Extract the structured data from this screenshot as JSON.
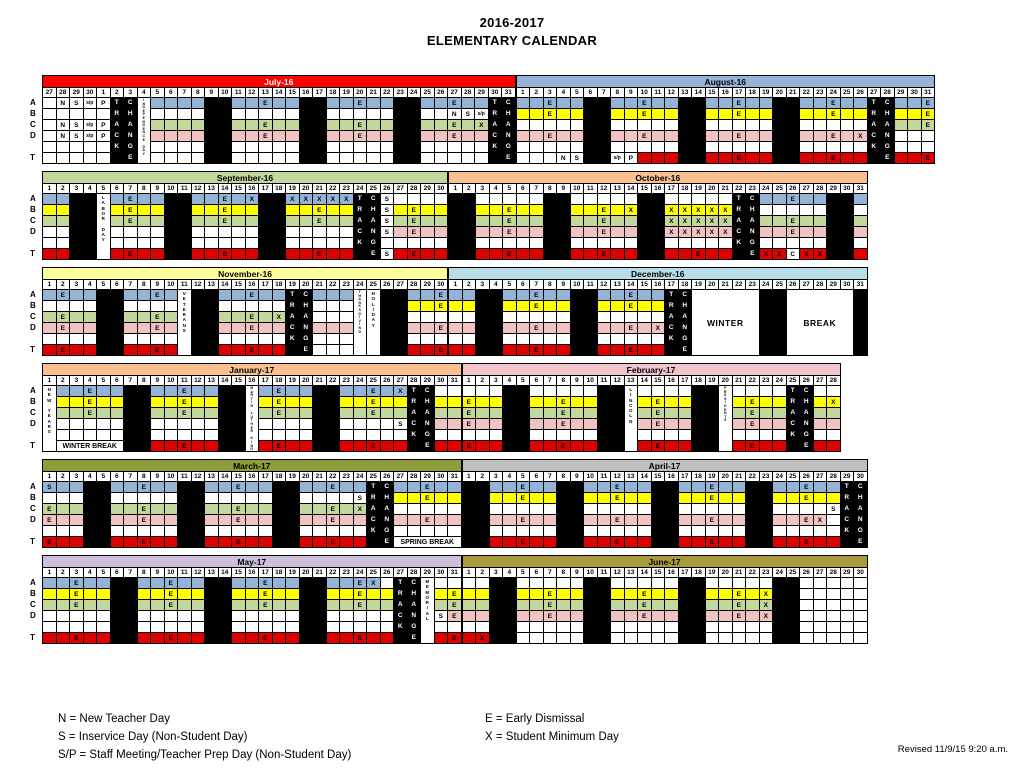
{
  "title": {
    "line1": "2016-2017",
    "line2": "ELEMENTARY CALENDAR"
  },
  "legend": {
    "n": "N = New Teacher Day",
    "s": "S = Inservice Day (Non-Student Day)",
    "sp": "S/P = Staff Meeting/Teacher Prep Day (Non-Student Day)",
    "e": "E = Early Dismissal",
    "x": "X = Student Minimum Day",
    "revised": "Revised 11/9/15 9:20 a.m."
  },
  "row_labels": [
    "A",
    "B",
    "C",
    "D",
    "",
    "T"
  ],
  "colors": {
    "a": "#95B3D7",
    "y": "#FFFF00",
    "g": "#C3D69B",
    "p": "#F0C2C4",
    "r": "#E00000",
    "k": "#000000",
    "w": "#FFFFFF"
  },
  "bands": [
    [
      0,
      1
    ],
    [
      2,
      3
    ],
    [
      4,
      5
    ],
    [
      6,
      7
    ],
    [
      8,
      9
    ],
    [
      10,
      11
    ]
  ],
  "months": [
    {
      "name": "July-16",
      "hbg": "#FF0000",
      "hfg": "#FFFFFF",
      "days": "27 28 29 30 1 2 3 4 5 6 7 8 9 10 11 12 13 14 15 16 17 18 19 20 21 22 23 24 25 26 27 28 29 30 31",
      "track_cols": {
        "5": "TRACK",
        "6": "CHANGE",
        "33": "TRACK",
        "34": "CHANGE"
      },
      "vcols": [
        {
          "col": 7,
          "text": "INDEPENDENCE DAY",
          "tiny": true
        }
      ],
      "merges": [],
      "rows": [
        "w w:N w:S w:s/p w:P k k w a a a a k k a a a:E a a k k a a a:E a a k k a a a:E a a k k",
        "w w w w w k k w w w w w k k w w w w w k k w w w w w k k w w w:N w:S w:s/p k k",
        "w w:N w:S w:s/p w:P k k w g g g g k k g g g:E g g k k g g g:E g g k k g g g:E g g:X k k",
        "w w:N w:S w:s/p w:P k k w p p p p k k p p p:E p p k k p p p:E p p k k p p p:E p p k k",
        "w w w w w k k w w w w w k k w w w w w k k w w w w w k k w w w w w k k",
        "w w w w w k k w w w w w k k w w w w w k k w w w w w k k w w w w w k k"
      ]
    },
    {
      "name": "August-16",
      "hbg": "#95B3D7",
      "hfg": "#000000",
      "days": "1 2 3 4 5 6 7 8 9 10 11 12 13 14 15 16 17 18 19 20 21 22 23 24 25 26 27 28 29 30 31",
      "track_cols": {
        "26": "TRACK",
        "27": "CHANGE"
      },
      "vcols": [],
      "merges": [],
      "rows": [
        "a a a:E a a k k a a a:E a a k k a a a:E a a k k a a a:E a a k k a a a:E",
        "y y y:E y y k k y y y:E y y k k y y y:E y y k k y y y:E y y k k y y y:E",
        "w w w w w k k w w w w w k k w w w w w k k w w w w w k k g g g:E",
        "p p p:E p p k k p p p:E p p k k p p p:E p p k k p p p:E p p:X k k w w w",
        "w w w w w k k w w w w w k k w w w w w k k w w w w w k k w w w",
        "w w w w:N w:S k k w:s/p w:P r r r k k r r r:E r r k k r r r:E r r k k r r r:E"
      ]
    },
    {
      "name": "September-16",
      "hbg": "#C3D69B",
      "hfg": "#000000",
      "days": "1 2 3 4 5 6 7 8 9 10 11 12 13 14 15 16 17 18 19 20 21 22 23 24 25 26 27 28 29 30",
      "track_cols": {
        "23": "TRACK",
        "24": "CHANGE"
      },
      "vcols": [
        {
          "col": 4,
          "text": "LABOR DAY",
          "tiny": false
        }
      ],
      "merges": [],
      "rows": [
        "a a k k w a a:E a a k k a a a:E a a:X k k a:X a:X a:X a:X a:X k k w:S w w w w",
        "y y k k w y y:E y y k k y y y:E y y k k y y y:E y y k k w:S y y:E y y",
        "g g k k w g g:E g g k k g g g:E g g k k g g g:E g g k k w:S g g:E g g",
        "w w k k w w w w w k k w w w w w k k w w w w w k k w:S p p:E p p",
        "w w k k w w w w w k k w w w w w k k w w w w w k k w w w w w",
        "r r k k w r r:E r r k k r r r:E r r k k r r r:E r r k k w:S r r:E r r"
      ]
    },
    {
      "name": "October-16",
      "hbg": "#FAC090",
      "hfg": "#000000",
      "days": "1 2 3 4 5 6 7 8 9 10 11 12 13 14 15 16 17 18 19 20 21 22 23 24 25 26 27 28 29 30 31",
      "track_cols": {
        "21": "TRACK",
        "22": "CHANGE"
      },
      "vcols": [],
      "merges": [],
      "rows": [
        "k k w w w w w k k w w w w w k k w w w w w k k a a a:E a a k k a",
        "k k y y y:E y y k k y y y:E y y:X k k y:X y:X y:X y:X y:X k k w w w w w k k w",
        "k k g g g:E g g k k g g g:E g g k k g:X g:X g:X g:X g:X k k g g g:E g g k k g",
        "k k p p p:E p p k k p p p:E p p k k p:X p:X p:X p:X p:X k k p p p:E p p k k p",
        "k k w w w w w k k w w w w w k k w w w w w k k w w w w w k k w",
        "k k r r r:E r r k k r r r:E r r k k r r r:E r r k k r:X r:X w:C r:X r:X k k r"
      ]
    },
    {
      "name": "November-16",
      "hbg": "#FFFF99",
      "hfg": "#000000",
      "days": "1 2 3 4 5 6 7 8 9 10 11 12 13 14 15 16 17 18 19 20 21 22 23 24 25 26 27 28 29 30",
      "track_cols": {
        "18": "TRACK",
        "19": "CHANGE"
      },
      "vcols": [
        {
          "col": 10,
          "text": "VETERANS",
          "tiny": false
        },
        {
          "col": 23,
          "text": "THANKSGIVING",
          "tiny": true
        },
        {
          "col": 24,
          "text": "HOLIDAY",
          "tiny": false
        }
      ],
      "merges": [],
      "rows": [
        "a a:E a a k k a a a:E a w k k a a a:E a a k k a a a w w k k a a a:E",
        "w w w w k k w w w w w k k w w w w w k k w w w w w k k y y y:E",
        "g g:E g g k k g g g:E g w k k g g g:E g g:X k k w w w w w k k w w w",
        "p p:E p p k k p p p:E p w k k p p p:E p p k k p p p w w k k p p p:E",
        "w w w w k k w w w w w k k w w w w w k k w w w w w k k w w w",
        "r r:E r r k k r r r:E r w k k r r r:E r r k k w w w w w k k r r r:E"
      ]
    },
    {
      "name": "December-16",
      "hbg": "#B7DEE8",
      "hfg": "#000000",
      "days": "1 2 3 4 5 6 7 8 9 10 11 12 13 14 15 16 17 18 19 20 21 22 23 24 25 26 27 28 29 30 31",
      "track_cols": {
        "16": "TRACK",
        "17": "CHANGE"
      },
      "vcols": [],
      "merges": [
        {
          "r0": 0,
          "r1": 5,
          "c0": 18,
          "c1": 22,
          "text": "WINTER",
          "big": true
        },
        {
          "r0": 0,
          "r1": 5,
          "c0": 25,
          "c1": 29,
          "text": "BREAK",
          "big": true
        }
      ],
      "rows": [
        "a a k k a a a:E a a k k a a a:E a a k k w w w w w k k w w w w w k",
        "y y k k y y y:E y y k k y y y:E y y k k w w w w w k k w w w w w k",
        "w w k k w w w w w k k w w w w w k k w w w w w k k w w w w w k",
        "p p k k p p p:E p p k k p p p:E p p:X k k w w w w w k k w w w w w k",
        "w w k k w w w w w k k w w w w w k k w w w w w k k w w w w w k",
        "r r k k r r r:E r r k k r r r:E r r k k w w w w w k k w w w w w k"
      ]
    },
    {
      "name": "January-17",
      "hbg": "#FAC090",
      "hfg": "#000000",
      "days": "1 2 3 4 5 6 7 8 9 10 11 12 13 14 15 16 17 18 19 20 21 22 23 24 25 26 27 28 29 30 31",
      "track_cols": {
        "27": "TRACK",
        "28": "CHANGE"
      },
      "vcols": [
        {
          "col": 0,
          "text": "NEW YEARS",
          "tiny": false
        },
        {
          "col": 15,
          "text": "MARTIN LUTHER KING",
          "tiny": true
        }
      ],
      "merges": [
        {
          "r0": 5,
          "r1": 5,
          "c0": 1,
          "c1": 5,
          "text": "WINTER BREAK",
          "big": false
        }
      ],
      "rows": [
        "w a a a:E a a k k a a a:E a a k k w a a:E a a k k a a a:E a a:X k k w w",
        "w y y y:E y y k k y y y:E y y k k w y y:E y y k k y y y:E y y k k y y",
        "w g g g:E g g k k g g g:E g g k k w g g:E g g k k g g g:E g g k k g g",
        "w w w w w w k k w w w w w k k w w w w w k k w w w w w:S k k p p",
        "w w w w w w k k w w w w w k k w w w w w k k w w w w w k k w w",
        "w w w w w w k k r r r:E r r k k w r r:E r r k k r r r:E r r k k r r"
      ]
    },
    {
      "name": "February-17",
      "hbg": "#F2C5CD",
      "hfg": "#000000",
      "days": "1 2 3 4 5 6 7 8 9 10 11 12 13 14 15 16 17 18 19 20 21 22 23 24 25 26 27 28",
      "track_cols": {
        "24": "TRACK",
        "25": "CHANGE"
      },
      "vcols": [
        {
          "col": 12,
          "text": "LINCOLN",
          "tiny": false
        },
        {
          "col": 19,
          "text": "PRESIDENTS",
          "tiny": true
        }
      ],
      "merges": [],
      "rows": [
        "w w w k k w w w w w k k w w w w w k k w w w w w k k w w",
        "y:E y y k k y y y:E y y k k w y y:E y y k k w y y:E y y k k y y:X",
        "g:E g g k k g g g:E g g k k w g g:E g g k k w g g:E g g k k g g",
        "p:E p p k k p p p:E p p k k w p p:E p p k k w p p:E p p k k p p",
        "w w w k k w w w w w k k w w w w w k k w w w w w k k w w",
        "r:E r r k k r r r:E r r k k w r r:E r r k k w r r:E r r k k r r"
      ]
    },
    {
      "name": "March-17",
      "hbg": "#8E9C3A",
      "hfg": "#000000",
      "days": "1 2 3 4 5 6 7 8 9 10 11 12 13 14 15 16 17 18 19 20 21 22 23 24 25 26 27 28 29 30 31",
      "track_cols": {
        "24": "TRACK",
        "25": "CHANGE"
      },
      "vcols": [],
      "merges": [
        {
          "r0": 5,
          "r1": 5,
          "c0": 26,
          "c1": 30,
          "text": "SPRING BREAK",
          "big": false
        }
      ],
      "rows": [
        "a:S a a k k a a a:E a a k k a a a:E a a k k a a a:E a a k k a a a:E a a",
        "w w w k k w w w w w k k w w w w w k k w w w w w:S k k y y y:E y y",
        "g:E g g k k g g g:E g g k k g g g:E g g k k g g g:E g g:X k k w w w w w",
        "p:E p p k k p p p:E p p k k p p p:E p p k k p p p:E p p k k p p p:E p p",
        "w w w k k w w w w w k k w w w w w k k w w w w w k k w w w w w",
        "r:E r r k k r r r:E r r k k r r r:E r r k k r r r:E r r k k w w w w w"
      ]
    },
    {
      "name": "April-17",
      "hbg": "#BFBFBF",
      "hfg": "#000000",
      "days": "1 2 3 4 5 6 7 8 9 10 11 12 13 14 15 16 17 18 19 20 21 22 23 24 25 26 27 28 29 30",
      "track_cols": {
        "28": "TRACK",
        "29": "CHANGE"
      },
      "vcols": [],
      "merges": [],
      "rows": [
        "k k a a a:E a a k k a a a:E a a k k a a a:E a a k k a a a:E a a k k",
        "k k y y y:E y y k k y y y:E y y k k y y y:E y y k k y y y:E y y k k",
        "k k w w w w w k k w w w w w k k w w w w w k k w w w w w:S k k",
        "k k p p p:E p p k k p p p:E p p k k p p p:E p p k k p p p:E p:X w k k",
        "k k w w w w w k k w w w w w k k w w w w w k k w w w w w k k",
        "k k r r r:E r r k k r r r:E r r k k r r r:E r r k k r r r:E r r k k"
      ]
    },
    {
      "name": "May-17",
      "hbg": "#CCC0DA",
      "hfg": "#000000",
      "days": "1 2 3 4 5 6 7 8 9 10 11 12 13 14 15 16 17 18 19 20 21 22 23 24 25 26 27 28 29 30 31",
      "track_cols": {
        "26": "TRACK",
        "27": "CHANGE"
      },
      "vcols": [
        {
          "col": 28,
          "text": "MEMORIAL",
          "tiny": false
        }
      ],
      "merges": [],
      "rows": [
        "a a a:E a a k k a a a:E a a k k a a a:E a a k k a a a:E a:X w k k w w w",
        "y y y:E y y k k y y y:E y y k k y y y:E y y k k y y y:E y y k k w y y:E",
        "g g g:E g g k k g g g:E g g k k g g g:E g g k k g g g:E g g k k w g g:E",
        "w w w w w k k w w w w w k k w w w w w k k w w w w w k k w w:S p:E",
        "w w w w w k k w w w w w k k w w w w w k k w w w w w k k w w w",
        "r r r:E r r k k r r r:E r r k k r r r:E r r k k r r r:E r r k k w r r:E"
      ]
    },
    {
      "name": "June-17",
      "hbg": "#A99A3B",
      "hfg": "#000000",
      "days": "1 2 3 4 5 6 7 8 9 10 11 12 13 14 15 16 17 18 19 20 21 22 23 24 25 26 27 28 29 30",
      "track_cols": {},
      "vcols": [],
      "merges": [],
      "rows": [
        "w w k k w w w w w k k w w w w w k k w w w w w k k w w w w w",
        "y y k k y y y:E y y k k y y y:E y y k k y y y:E y y:X k k w w w w w",
        "g g k k g g g:E g g k k g g g:E g g k k g g g:E g g:X k k w w w w w",
        "p p k k p p p:E p p k k p p p:E p p k k p p p:E p p:X k k w w w w w",
        "w w k k w w w w w k k w w w w w k k w w w w w k k w w w w w",
        "r r:X k k w w w w w k k w w w w w k k w w w w w k k w w w w w"
      ]
    }
  ]
}
